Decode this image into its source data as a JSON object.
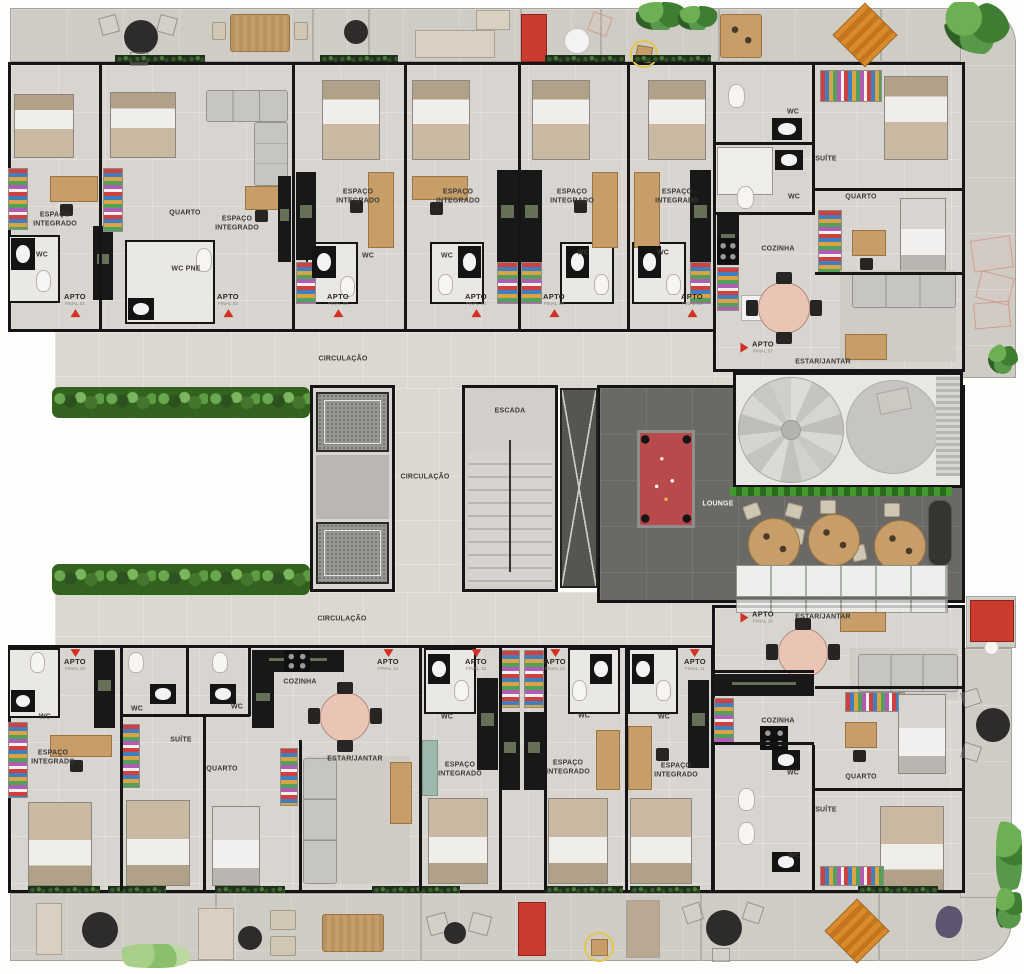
{
  "palette": {
    "accent_red": "#d23226",
    "wall_black": "#151515",
    "floor_light": "#d8d4cf",
    "balcony_floor": "#cfccc5",
    "lounge_floor": "#6b6965",
    "pool_felt": "#b84a4c",
    "wood": "#c79e6a",
    "hedge_green": "#33621f",
    "pink_table": "#eac4b5"
  },
  "labels": [
    {
      "text": "ESPAÇO\nINTEGRADO",
      "x": 55,
      "y": 220
    },
    {
      "text": "WC",
      "x": 42,
      "y": 256
    },
    {
      "text": "QUARTO",
      "x": 185,
      "y": 214
    },
    {
      "text": "ESPAÇO\nINTEGRADO",
      "x": 237,
      "y": 224
    },
    {
      "text": "WC PNE",
      "x": 186,
      "y": 270
    },
    {
      "text": "ESPAÇO\nINTEGRADO",
      "x": 358,
      "y": 197
    },
    {
      "text": "WC",
      "x": 368,
      "y": 257
    },
    {
      "text": "ESPAÇO\nINTEGRADO",
      "x": 458,
      "y": 197
    },
    {
      "text": "WC",
      "x": 447,
      "y": 257
    },
    {
      "text": "ESPAÇO\nINTEGRADO",
      "x": 572,
      "y": 197
    },
    {
      "text": "WC",
      "x": 583,
      "y": 254
    },
    {
      "text": "ESPAÇO\nINTEGRADO",
      "x": 677,
      "y": 197
    },
    {
      "text": "WC",
      "x": 663,
      "y": 254
    },
    {
      "text": "WC",
      "x": 793,
      "y": 113
    },
    {
      "text": "SUÍTE",
      "x": 826,
      "y": 160
    },
    {
      "text": "WC",
      "x": 794,
      "y": 198
    },
    {
      "text": "QUARTO",
      "x": 861,
      "y": 198
    },
    {
      "text": "COZINHA",
      "x": 778,
      "y": 250
    },
    {
      "text": "ESTAR/JANTAR",
      "x": 823,
      "y": 363
    },
    {
      "text": "CIRCULAÇÃO",
      "x": 343,
      "y": 360
    },
    {
      "text": "ESCADA",
      "x": 510,
      "y": 412
    },
    {
      "text": "CIRCULAÇÃO",
      "x": 425,
      "y": 478
    },
    {
      "text": "LOUNGE",
      "x": 718,
      "y": 505,
      "light": true
    },
    {
      "text": "CIRCULAÇÃO",
      "x": 342,
      "y": 620
    },
    {
      "text": "WC",
      "x": 45,
      "y": 718
    },
    {
      "text": "ESPAÇO\nINTEGRADO",
      "x": 53,
      "y": 758
    },
    {
      "text": "WC",
      "x": 137,
      "y": 710
    },
    {
      "text": "SUÍTE",
      "x": 181,
      "y": 741
    },
    {
      "text": "WC",
      "x": 237,
      "y": 708
    },
    {
      "text": "QUARTO",
      "x": 222,
      "y": 770
    },
    {
      "text": "COZINHA",
      "x": 300,
      "y": 683
    },
    {
      "text": "ESTAR/JANTAR",
      "x": 355,
      "y": 760
    },
    {
      "text": "WC",
      "x": 447,
      "y": 718
    },
    {
      "text": "ESPAÇO\nINTEGRADO",
      "x": 460,
      "y": 770
    },
    {
      "text": "WC",
      "x": 584,
      "y": 717
    },
    {
      "text": "ESPAÇO\nINTEGRADO",
      "x": 568,
      "y": 768
    },
    {
      "text": "WC",
      "x": 664,
      "y": 718
    },
    {
      "text": "ESPAÇO\nINTEGRADO",
      "x": 676,
      "y": 771
    },
    {
      "text": "ESTAR/JANTAR",
      "x": 823,
      "y": 618
    },
    {
      "text": "COZINHA",
      "x": 778,
      "y": 722
    },
    {
      "text": "WC",
      "x": 793,
      "y": 774
    },
    {
      "text": "QUARTO",
      "x": 861,
      "y": 778
    },
    {
      "text": "SUÍTE",
      "x": 826,
      "y": 811
    },
    {
      "text": "WC",
      "x": 794,
      "y": 857
    }
  ],
  "apartments": [
    {
      "apto": "APTO",
      "final": "FINAL 01",
      "x": 75,
      "y": 305,
      "dir": "up"
    },
    {
      "apto": "APTO",
      "final": "FINAL 02",
      "x": 228,
      "y": 305,
      "dir": "up"
    },
    {
      "apto": "APTO",
      "final": "FINAL 03",
      "x": 338,
      "y": 305,
      "dir": "up"
    },
    {
      "apto": "APTO",
      "final": "FINAL 04",
      "x": 476,
      "y": 305,
      "dir": "up"
    },
    {
      "apto": "APTO",
      "final": "FINAL 05",
      "x": 554,
      "y": 305,
      "dir": "up"
    },
    {
      "apto": "APTO",
      "final": "FINAL 06",
      "x": 692,
      "y": 305,
      "dir": "up"
    },
    {
      "apto": "APTO",
      "final": "FINAL 07",
      "x": 758,
      "y": 348,
      "dir": "right"
    },
    {
      "apto": "APTO",
      "final": "FINAL 10",
      "x": 758,
      "y": 618,
      "dir": "right"
    },
    {
      "apto": "APTO",
      "final": "FINAL 11",
      "x": 695,
      "y": 661,
      "dir": "down"
    },
    {
      "apto": "APTO",
      "final": "FINAL 12",
      "x": 555,
      "y": 661,
      "dir": "down"
    },
    {
      "apto": "APTO",
      "final": "FINAL 13",
      "x": 476,
      "y": 661,
      "dir": "down"
    },
    {
      "apto": "APTO",
      "final": "FINAL 14",
      "x": 388,
      "y": 661,
      "dir": "down"
    },
    {
      "apto": "APTO",
      "final": "FINAL 15",
      "x": 75,
      "y": 661,
      "dir": "down"
    }
  ]
}
